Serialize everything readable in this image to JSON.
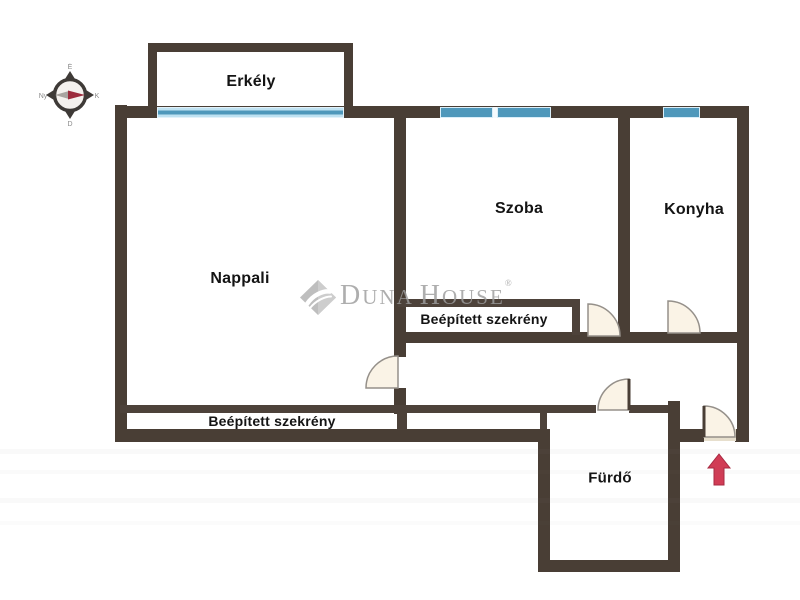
{
  "plan": {
    "type": "apartment floor plan",
    "labels": {
      "erkely": "Erkély",
      "nappali": "Nappali",
      "szoba": "Szoba",
      "konyha": "Konyha",
      "szekreny_upper": "Beépített szekrény",
      "szekreny_lower": "Beépített szekrény",
      "furdo": "Fürdő"
    }
  },
  "compass": {
    "north": "É",
    "east": "K",
    "south": "D",
    "west": "Ny"
  },
  "watermark": {
    "d": "D",
    "una": "UNA",
    "h": "H",
    "ouse": "OUSE",
    "reg": "®"
  },
  "colors": {
    "wall": "#493e35",
    "window_blue": "#4f98bb",
    "window_light_blue": "#bfe2f2",
    "door_fill": "#faf3e6",
    "door_arc": "#95908a",
    "entrance_arrow": "#d13c55",
    "compass_needle_red": "#9c2c3d",
    "watermark_gray": "#9d9d9d",
    "background": "#ffffff"
  }
}
